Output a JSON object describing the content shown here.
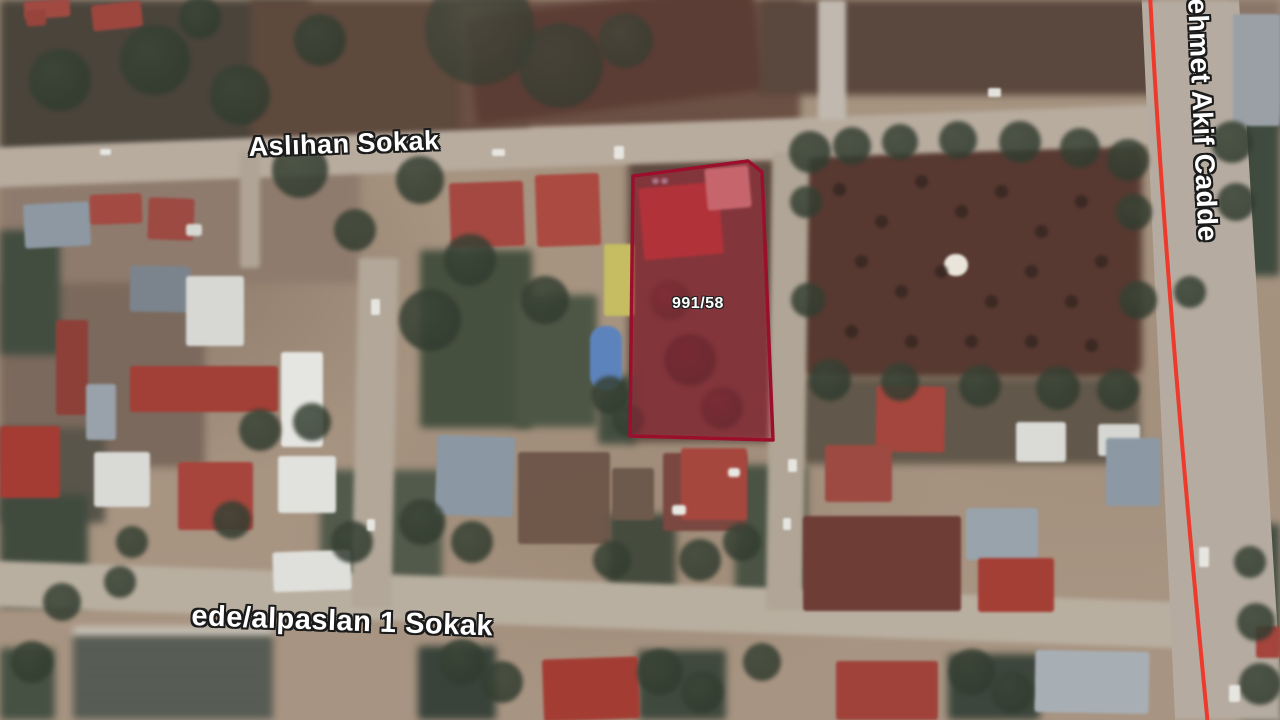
{
  "map": {
    "labels": {
      "street_top": "Aslıhan Sokak",
      "street_bottom": "ede/alpaslan 1 Sokak",
      "street_right": "Mehmet Akif Cadde",
      "parcel": "991/58"
    },
    "colors": {
      "parcel_border": "#9b0f2d",
      "parcel_fill": "rgba(186,22,52,0.40)",
      "route_line": "#ee392d",
      "road": "#b8ac9f",
      "ground": "#a89482"
    },
    "parcel": {
      "points": "633,176 748,161 762,172 773,440 630,436",
      "stroke_width": 3.5
    },
    "route": {
      "path": "M 1150,-6 C 1163,240 1186,500 1208,726",
      "stroke_width": 4
    },
    "scene": {
      "fields": [
        [
          0,
          0,
          310,
          158,
          "#4a443b"
        ],
        [
          250,
          0,
          280,
          152,
          "#5e493d"
        ],
        [
          460,
          0,
          340,
          128,
          "#6b5044"
        ],
        [
          470,
          0,
          290,
          108,
          "#5c3d35",
          -7
        ],
        [
          760,
          0,
          395,
          95,
          "#5a473d"
        ],
        [
          1230,
          0,
          50,
          132,
          "#8a7668"
        ],
        [
          800,
          146,
          342,
          232,
          "#573931",
          0,
          14
        ],
        [
          0,
          158,
          360,
          125,
          "#8e7b6d"
        ],
        [
          0,
          282,
          205,
          185,
          "#7b695d"
        ],
        [
          0,
          230,
          60,
          125,
          "#424d40"
        ],
        [
          0,
          428,
          105,
          95,
          "#59554a"
        ],
        [
          628,
          160,
          152,
          282,
          "#5e4a40"
        ],
        [
          73,
          627,
          200,
          9,
          "#cbc8bf"
        ],
        [
          73,
          635,
          200,
          85,
          "#3c4640",
          0,
          2,
          1,
          "stripes"
        ],
        [
          0,
          648,
          55,
          72,
          "#465143"
        ],
        [
          420,
          250,
          112,
          178,
          "#46503f"
        ],
        [
          515,
          295,
          82,
          132,
          "#4d5645"
        ],
        [
          598,
          376,
          38,
          68,
          "#444e40"
        ],
        [
          320,
          470,
          122,
          132,
          "#525a4b"
        ],
        [
          0,
          495,
          88,
          112,
          "#404b3e"
        ],
        [
          608,
          514,
          68,
          92,
          "#454b3d"
        ],
        [
          735,
          465,
          72,
          142,
          "#4b5344"
        ],
        [
          800,
          378,
          340,
          86,
          "#61574a"
        ],
        [
          948,
          654,
          92,
          66,
          "#3c463c"
        ],
        [
          418,
          646,
          78,
          74,
          "#39433a"
        ],
        [
          638,
          650,
          88,
          70,
          "#3f493d"
        ],
        [
          1224,
          114,
          56,
          162,
          "#404b3f"
        ],
        [
          1240,
          524,
          40,
          196,
          "#444e42"
        ]
      ],
      "roads": [
        [
          -10,
          126,
          1178,
          40,
          "#b8ac9f",
          -2.1
        ],
        [
          -10,
          582,
          1225,
          46,
          "#b9afa0",
          2.0
        ],
        [
          355,
          258,
          40,
          350,
          "#b2a799",
          1.2
        ],
        [
          769,
          152,
          37,
          458,
          "#b0a596",
          0.8
        ],
        [
          240,
          152,
          20,
          116,
          "#b0a496",
          0
        ],
        [
          818,
          0,
          28,
          120,
          "#c1b9af",
          0
        ]
      ],
      "road_right": {
        "x": 1128,
        "y": 0,
        "w": 152,
        "h": 720,
        "c": "#b5aba0",
        "clip": "polygon(9% 0%, 73% 0%, 102% 100%, 31% 100%)"
      },
      "buildings": [
        [
          24,
          0,
          46,
          18,
          "#a04a42",
          -4
        ],
        [
          26,
          10,
          20,
          16,
          "#96443c",
          -4
        ],
        [
          92,
          3,
          50,
          26,
          "#9c463e",
          -6
        ],
        [
          24,
          203,
          66,
          44,
          "#8d98a3",
          -3
        ],
        [
          90,
          194,
          52,
          30,
          "#a34a42",
          -2
        ],
        [
          148,
          198,
          46,
          42,
          "#9c4a42",
          2
        ],
        [
          186,
          224,
          16,
          12,
          "#d8d8d2",
          0
        ],
        [
          130,
          266,
          60,
          46,
          "#7b848c",
          1
        ],
        [
          186,
          276,
          58,
          70,
          "#d7d8d4",
          0
        ],
        [
          56,
          320,
          32,
          95,
          "#8d4038",
          0
        ],
        [
          130,
          366,
          148,
          46,
          "#a23f36",
          0
        ],
        [
          86,
          384,
          30,
          56,
          "#99a1aa",
          0
        ],
        [
          0,
          426,
          60,
          72,
          "#a43c33",
          0
        ],
        [
          94,
          452,
          56,
          55,
          "#d9d9d5",
          0
        ],
        [
          178,
          462,
          75,
          68,
          "#a7453c",
          0
        ],
        [
          278,
          456,
          58,
          57,
          "#e1e1dd",
          0
        ],
        [
          281,
          352,
          42,
          95,
          "#e5e5e1",
          0
        ],
        [
          450,
          182,
          74,
          65,
          "#a54841",
          -2
        ],
        [
          536,
          174,
          64,
          72,
          "#ab4a40",
          -2
        ],
        [
          604,
          244,
          30,
          72,
          "#c6bd62",
          0
        ],
        [
          590,
          326,
          32,
          64,
          "#5d83bd",
          0,
          14
        ],
        [
          641,
          185,
          80,
          72,
          "#ad453c",
          -5
        ],
        [
          706,
          167,
          44,
          42,
          "#d09a92",
          -5
        ],
        [
          663,
          453,
          84,
          78,
          "#7a4840",
          0
        ],
        [
          612,
          468,
          42,
          52,
          "#6e5a4c",
          0
        ],
        [
          436,
          436,
          78,
          80,
          "#8b97a3",
          2
        ],
        [
          518,
          452,
          92,
          92,
          "#6a5346",
          0,
          3,
          0.9
        ],
        [
          681,
          448,
          66,
          72,
          "#a6473e",
          0
        ],
        [
          876,
          386,
          69,
          66,
          "#a4463d",
          1
        ],
        [
          1016,
          422,
          50,
          40,
          "#dadad6",
          0
        ],
        [
          1098,
          424,
          42,
          32,
          "#d6d6d2",
          0
        ],
        [
          825,
          445,
          67,
          57,
          "#9c4a42",
          0
        ],
        [
          803,
          516,
          158,
          95,
          "#6e3d36",
          0
        ],
        [
          966,
          508,
          72,
          52,
          "#99a3ab",
          0
        ],
        [
          978,
          558,
          76,
          54,
          "#a43f36",
          0
        ],
        [
          1106,
          438,
          54,
          68,
          "#8c99a5",
          0
        ],
        [
          1035,
          651,
          114,
          62,
          "#a7afb5",
          1
        ],
        [
          836,
          661,
          102,
          59,
          "#a0423a",
          0
        ],
        [
          543,
          658,
          96,
          62,
          "#a33d34",
          -2
        ],
        [
          273,
          551,
          78,
          40,
          "#dfdfdb",
          -2
        ],
        [
          1256,
          626,
          24,
          32,
          "#a4443c",
          0
        ],
        [
          1233,
          14,
          47,
          112,
          "#9aa0a6",
          0
        ],
        [
          944,
          254,
          24,
          22,
          "#e9e5db",
          0,
          12
        ],
        [
          672,
          505,
          14,
          10,
          "#e8e8e2",
          0
        ],
        [
          728,
          468,
          12,
          9,
          "#e8e8e2",
          0
        ],
        [
          652,
          178,
          7,
          6,
          "#9fb4c0",
          0
        ],
        [
          661,
          178,
          7,
          6,
          "#9fb4c0",
          0
        ]
      ],
      "trees": [
        [
          155,
          60,
          70
        ],
        [
          240,
          95,
          60
        ],
        [
          60,
          80,
          62
        ],
        [
          320,
          40,
          52
        ],
        [
          200,
          18,
          42
        ],
        [
          480,
          30,
          110,
          "#454c40",
          0.7
        ],
        [
          560,
          65,
          85,
          "#3f463a",
          0.7
        ],
        [
          625,
          40,
          55,
          "#41483b",
          0.7
        ],
        [
          420,
          180,
          48
        ],
        [
          300,
          170,
          56
        ],
        [
          355,
          230,
          42
        ],
        [
          430,
          320,
          62
        ],
        [
          470,
          260,
          52
        ],
        [
          545,
          300,
          48
        ],
        [
          610,
          395,
          38
        ],
        [
          628,
          420,
          32
        ],
        [
          690,
          360,
          52,
          "#4a3434",
          0.9
        ],
        [
          722,
          408,
          42,
          "#503a36",
          0.9
        ],
        [
          670,
          300,
          40,
          "#5a3c38",
          0.8
        ],
        [
          810,
          152,
          42
        ],
        [
          852,
          146,
          38
        ],
        [
          900,
          142,
          36
        ],
        [
          958,
          140,
          38
        ],
        [
          1020,
          142,
          42
        ],
        [
          1080,
          148,
          40
        ],
        [
          1128,
          160,
          42
        ],
        [
          806,
          202,
          32
        ],
        [
          1134,
          212,
          36
        ],
        [
          808,
          300,
          34
        ],
        [
          1138,
          300,
          38
        ],
        [
          830,
          380,
          42
        ],
        [
          900,
          382,
          38
        ],
        [
          980,
          386,
          42
        ],
        [
          1058,
          388,
          44
        ],
        [
          1118,
          390,
          42
        ],
        [
          1190,
          292,
          32
        ],
        [
          1232,
          142,
          42
        ],
        [
          1236,
          202,
          38
        ],
        [
          1250,
          562,
          32
        ],
        [
          1256,
          622,
          38
        ],
        [
          1260,
          684,
          42
        ],
        [
          462,
          662,
          46
        ],
        [
          502,
          682,
          42
        ],
        [
          660,
          672,
          46
        ],
        [
          702,
          692,
          42
        ],
        [
          762,
          662,
          38
        ],
        [
          972,
          672,
          46
        ],
        [
          1012,
          692,
          42
        ],
        [
          120,
          582,
          32
        ],
        [
          62,
          602,
          38
        ],
        [
          32,
          662,
          42
        ],
        [
          260,
          430,
          42
        ],
        [
          312,
          422,
          38
        ],
        [
          232,
          520,
          38
        ],
        [
          132,
          542,
          32
        ],
        [
          352,
          542,
          42
        ],
        [
          422,
          522,
          46
        ],
        [
          472,
          542,
          42
        ],
        [
          612,
          560,
          38
        ],
        [
          700,
          560,
          42
        ],
        [
          742,
          542,
          38
        ]
      ],
      "orchard_dots": [
        [
          840,
          190
        ],
        [
          882,
          222
        ],
        [
          922,
          182
        ],
        [
          962,
          212
        ],
        [
          1002,
          192
        ],
        [
          1042,
          232
        ],
        [
          1082,
          202
        ],
        [
          862,
          262
        ],
        [
          902,
          292
        ],
        [
          942,
          272
        ],
        [
          992,
          302
        ],
        [
          1032,
          272
        ],
        [
          1072,
          302
        ],
        [
          1102,
          262
        ],
        [
          852,
          332
        ],
        [
          912,
          342
        ],
        [
          972,
          342
        ],
        [
          1032,
          342
        ],
        [
          1092,
          346
        ]
      ],
      "vehicles": [
        [
          492,
          149,
          13,
          7
        ],
        [
          614,
          146,
          10,
          13
        ],
        [
          988,
          88,
          13,
          9
        ],
        [
          788,
          459,
          9,
          13
        ],
        [
          783,
          518,
          8,
          12
        ],
        [
          1199,
          547,
          10,
          20
        ],
        [
          1229,
          685,
          11,
          17
        ],
        [
          371,
          299,
          9,
          16
        ],
        [
          367,
          519,
          8,
          12
        ],
        [
          100,
          149,
          11,
          6
        ]
      ]
    }
  }
}
